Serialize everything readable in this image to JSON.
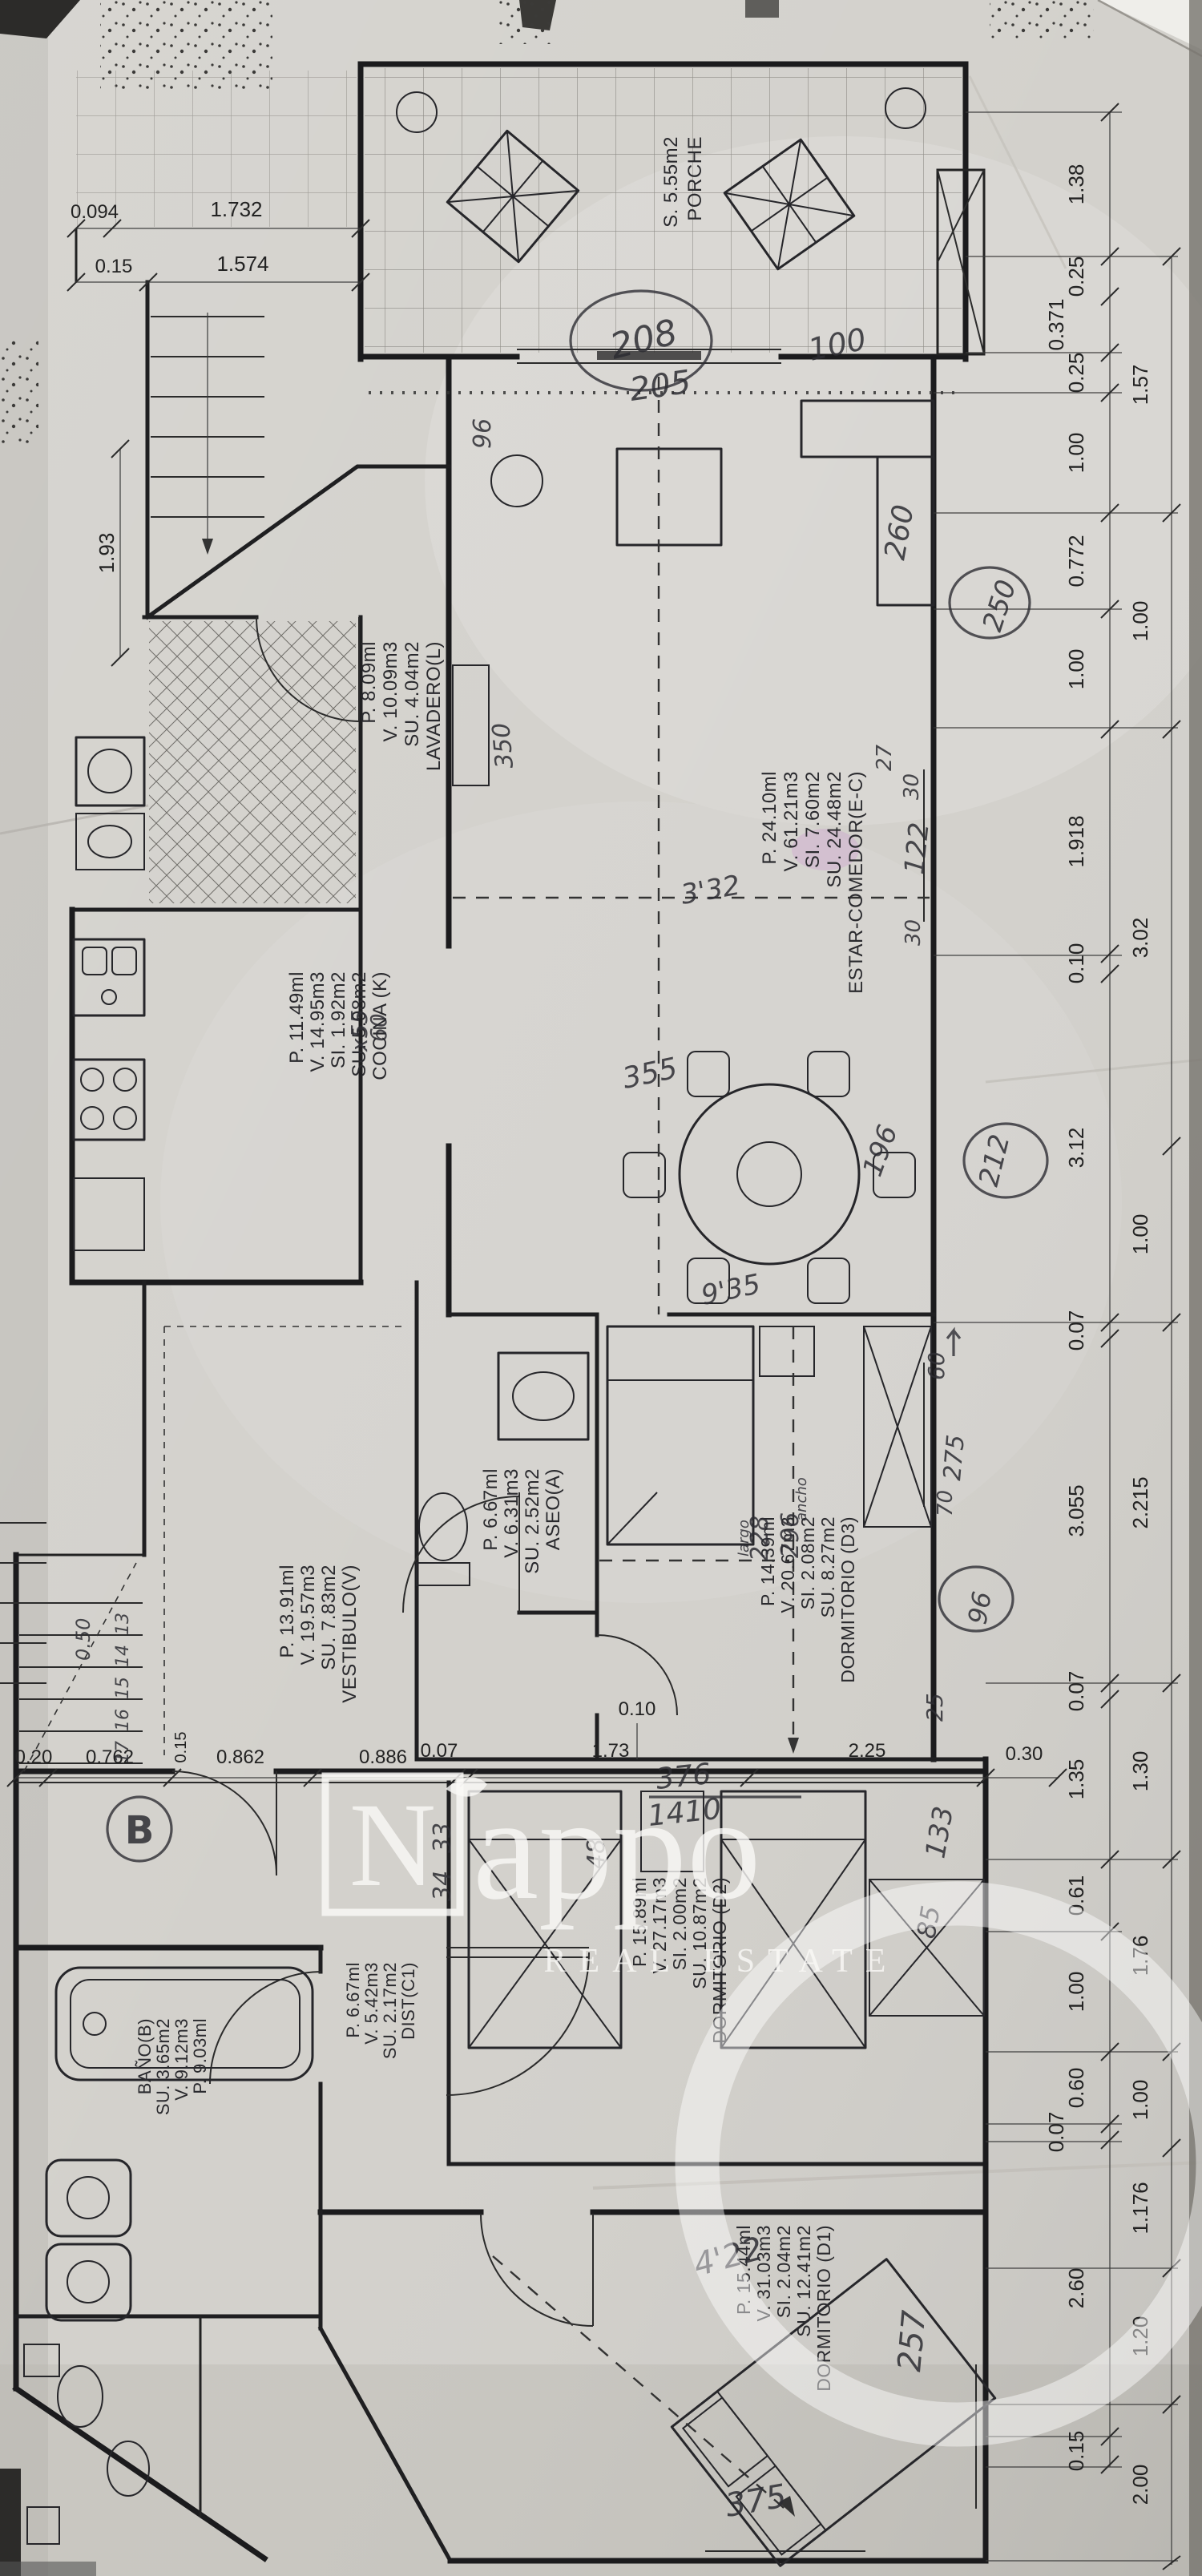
{
  "watermark": {
    "brand_initial": "N",
    "brand_rest": "appo",
    "tagline": "REAL ESTATE"
  },
  "rooms": [
    {
      "id": "porche",
      "name": "PORCHE",
      "lines": [
        "S. 5.55m2"
      ]
    },
    {
      "id": "estar",
      "name": "ESTAR-COMEDOR(E-C)",
      "lines": [
        "SU. 24.48m2",
        "SI. 7.60m2",
        "V. 61.21m3",
        "P. 24.10ml"
      ]
    },
    {
      "id": "lavadero",
      "name": "LAVADERO(L)",
      "lines": [
        "SU. 4.04m2",
        "V. 10.09m3",
        "P. 8.09ml"
      ]
    },
    {
      "id": "cocina",
      "name": "COCINA (K)",
      "lines": [
        "SU. 5.98m2",
        "SI. 1.92m2",
        "V. 14.95m3",
        "P. 11.49ml"
      ]
    },
    {
      "id": "aseo",
      "name": "ASEO(A)",
      "lines": [
        "SU. 2.52m2",
        "V. 6.31m3",
        "P. 6.67ml"
      ]
    },
    {
      "id": "vestibulo",
      "name": "VESTIBULO(V)",
      "lines": [
        "SU. 7.83m2",
        "V. 19.57m3",
        "P. 13.91ml"
      ]
    },
    {
      "id": "d3",
      "name": "DORMITORIO (D3)",
      "lines": [
        "SU. 8.27m2",
        "SI. 2.08m2",
        "V. 20.67m3",
        "P. 14.39ml"
      ]
    },
    {
      "id": "d2",
      "name": "DORMITORIO (D2)",
      "lines": [
        "SU. 10.87m2",
        "SI. 2.00m2",
        "V. 27.17m3",
        "P. 15.89ml"
      ]
    },
    {
      "id": "dist",
      "name": "DIST(C1)",
      "lines": [
        "SU. 2.17m2",
        "V. 5.42m3",
        "P. 6.67ml"
      ]
    },
    {
      "id": "bano",
      "name": "BAÑO(B)",
      "lines": [
        "SU. 3.65m2",
        "V. 9.12m3",
        "P. 9.03ml"
      ]
    },
    {
      "id": "d1",
      "name": "DORMITORIO (D1)",
      "lines": [
        "SU. 12.41m2",
        "SI. 2.04m2",
        "V. 31.03m3",
        "P. 15.44ml"
      ]
    }
  ],
  "dims": {
    "top": [
      "0.094",
      "1.732",
      "0.15",
      "1.574"
    ],
    "left": [
      "1.93"
    ],
    "right_inner": [
      "1.38",
      "0.25",
      "0.371",
      "0.25",
      "1.00",
      "0.772",
      "1.00",
      "1.918",
      "0.10",
      "3.12",
      "0.07",
      "3.055",
      "0.07",
      "1.35",
      "0.61",
      "1.00",
      "0.60",
      "0.07",
      "2.60",
      "0.15"
    ],
    "right_outer": [
      "1.57",
      "1.00",
      "3.02",
      "1.00",
      "2.215",
      "1.30",
      "1.76",
      "1.00",
      "1.176",
      "1.20",
      "2.00"
    ],
    "middle": [
      "0.20",
      "0.762",
      "0.15",
      "0.862",
      "0.886",
      "0.07",
      "1.73",
      "0.10",
      "2.25",
      "0.30"
    ]
  },
  "hw": {
    "n96a": "96",
    "n208": "208",
    "n205": "205",
    "n100": "100",
    "n260": "260",
    "n250": "250",
    "n27": "27",
    "n30a": "30",
    "n122": "122",
    "n30b": "30",
    "n350": "350",
    "n332": "3'32",
    "n60k": "60",
    "n55k": "x55",
    "n355": "355",
    "n196": "196",
    "n212": "212",
    "n935": "9'35",
    "n60": "60",
    "n275": "275",
    "n70": "70",
    "ancho": "ancho",
    "n296": "296",
    "n228": "228",
    "largo": "largo",
    "n96b": "96",
    "n25": "25",
    "n050": "0.50",
    "s13": "13",
    "s14": "14",
    "s15": "15",
    "s16": "16",
    "s17": "17",
    "bmark": "B",
    "n33": "33",
    "n34": "34",
    "n48": "48",
    "n376": "376",
    "n1410": "1410",
    "n133": "133",
    "n85": "85",
    "n422": "4'22",
    "n257": "257",
    "n375": "375"
  }
}
